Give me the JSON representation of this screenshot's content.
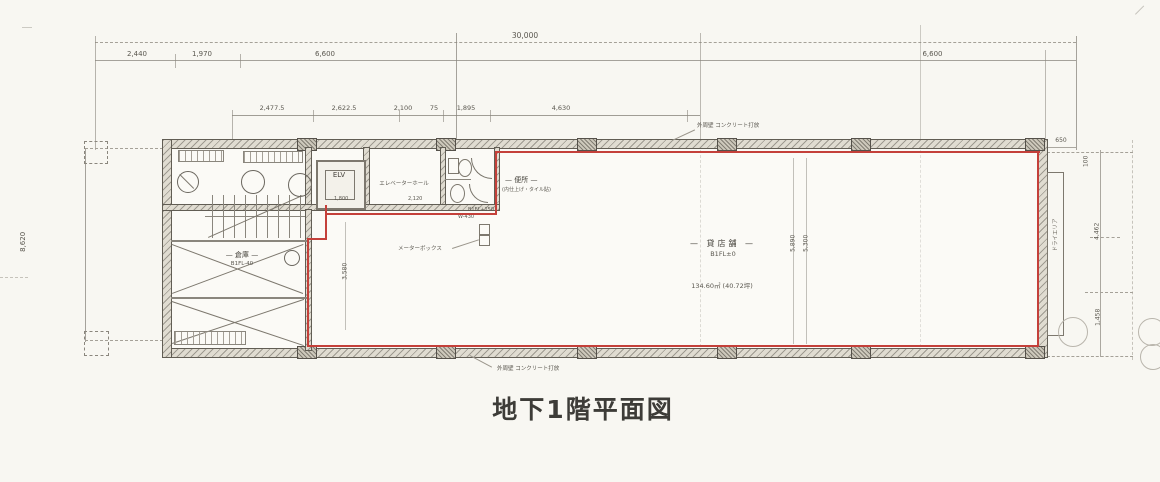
{
  "title": "地下1階平面図",
  "dims": {
    "overall": "30,000",
    "top_seg1": "2,440",
    "top_seg2": "1,970",
    "top_seg3": "6,600",
    "top_seg4": "6,600",
    "sub_seg1": "2,477.5",
    "sub_seg2": "2,622.5",
    "sub_seg3": "2,100",
    "sub_seg4": "75",
    "sub_seg5": "1,895",
    "sub_seg6": "4,630",
    "left_height": "8,620",
    "right_650": "650",
    "right_100": "100",
    "right_4462": "4,462",
    "right_1458": "1,458",
    "mid_5890": "5,890",
    "mid_5300": "5,300",
    "mid_3580": "3,580",
    "inner_1800": "1,800",
    "inner_2120": "2,120",
    "inner_w430": "W-430",
    "inner_level": "B1FL+150"
  },
  "rooms": {
    "main_name": "— 貸店舗 —",
    "main_level": "B1FL±0",
    "main_area": "134.60㎡ (40.72坪)",
    "elv": "ELV",
    "hall": "エレベーターホール",
    "toilet": "— 便所 —",
    "toilet_note": "(内仕上げ・タイル貼)",
    "storage_name": "— 倉庫 —",
    "storage_level": "B1FL-40"
  },
  "notes": {
    "outer_wall_top": "外周壁 コンクリート打放",
    "outer_wall_bottom": "外周壁 コンクリート打放",
    "meter_box": "メーターボックス",
    "dry_area": "ドライエリア"
  }
}
